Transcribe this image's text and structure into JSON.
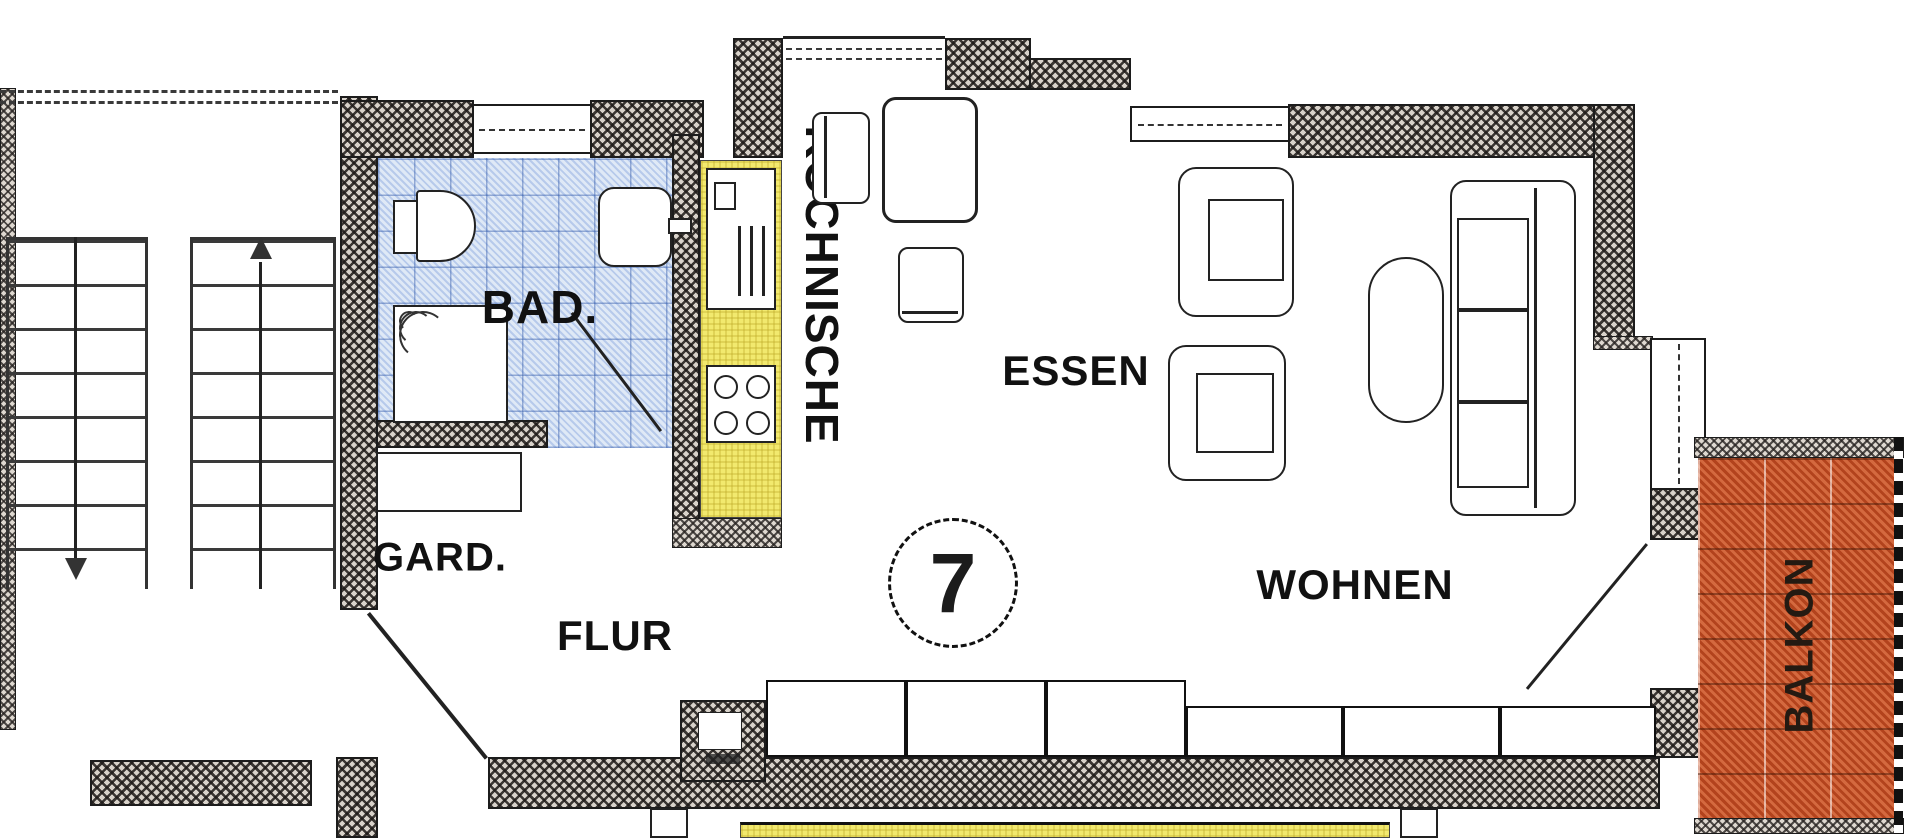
{
  "plan": {
    "unit_number": "7",
    "rooms": {
      "bad": "BAD.",
      "kochnische": "KOCHNISCHE",
      "essen": "ESSEN",
      "wohnen": "WOHNEN",
      "gard": "GARD.",
      "flur": "FLUR",
      "balkon": "BALKON"
    },
    "colors": {
      "bath_tile": "#dfe9f6",
      "kitchen_counter": "#f2e96e",
      "balcony_tile": "#c8552e",
      "wall_fill": "#d8d2ca",
      "line": "#1c1c1c"
    }
  }
}
